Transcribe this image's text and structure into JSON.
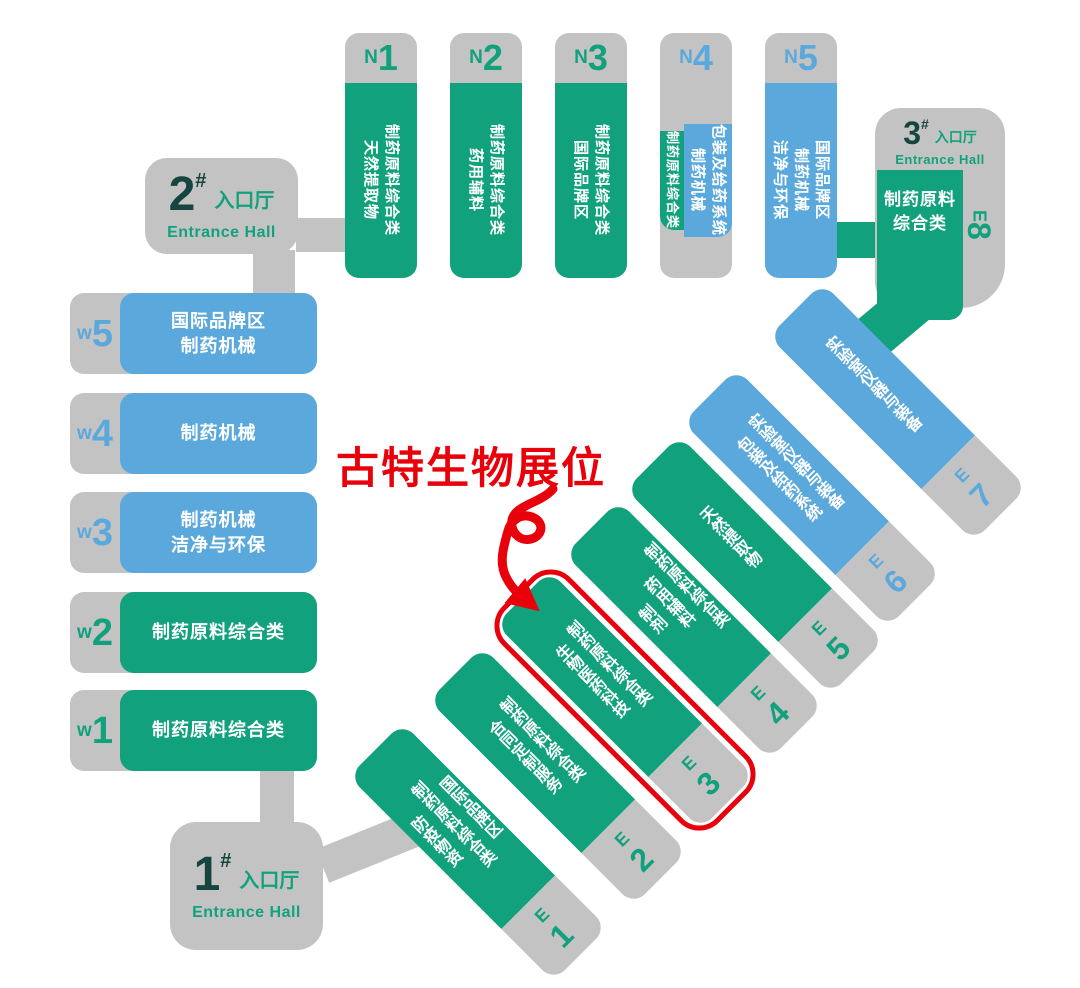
{
  "annotation": {
    "booth_label": "古特生物展位"
  },
  "entrances": {
    "e1": {
      "num": "1",
      "hash": "#",
      "cn": "入口厅",
      "en": "Entrance Hall"
    },
    "e2": {
      "num": "2",
      "hash": "#",
      "cn": "入口厅",
      "en": "Entrance Hall"
    },
    "e3": {
      "num": "3",
      "hash": "#",
      "cn": "入口厅",
      "en": "Entrance Hall"
    }
  },
  "n_halls": [
    {
      "prefix": "N",
      "num": "1",
      "color": "green",
      "lines": [
        "制药原料综合类",
        "天然提取物"
      ]
    },
    {
      "prefix": "N",
      "num": "2",
      "color": "green",
      "lines": [
        "制药原料综合类",
        "药用辅料"
      ]
    },
    {
      "prefix": "N",
      "num": "3",
      "color": "green",
      "lines": [
        "制药原料综合类",
        "国际品牌区"
      ]
    },
    {
      "prefix": "N",
      "num": "4",
      "color": "split",
      "strip_line": "制药原料综合类",
      "lines": [
        "包装及给药系统",
        "制药机械"
      ]
    },
    {
      "prefix": "N",
      "num": "5",
      "color": "blue",
      "lines": [
        "国际品牌区",
        "制药机械",
        "洁净与环保"
      ]
    }
  ],
  "w_halls": [
    {
      "prefix": "w",
      "num": "5",
      "color": "blue",
      "lines": [
        "国际品牌区",
        "制药机械"
      ]
    },
    {
      "prefix": "w",
      "num": "4",
      "color": "blue",
      "lines": [
        "制药机械"
      ]
    },
    {
      "prefix": "w",
      "num": "3",
      "color": "blue",
      "lines": [
        "制药机械",
        "洁净与环保"
      ]
    },
    {
      "prefix": "w",
      "num": "2",
      "color": "green",
      "lines": [
        "制药原料综合类"
      ]
    },
    {
      "prefix": "w",
      "num": "1",
      "color": "green",
      "lines": [
        "制药原料综合类"
      ]
    }
  ],
  "e_halls": [
    {
      "prefix": "E",
      "num": "1",
      "color": "green",
      "highlighted": false,
      "lines": [
        "国际品牌区",
        "制药原料综合类",
        "防疫物资"
      ]
    },
    {
      "prefix": "E",
      "num": "2",
      "color": "green",
      "highlighted": false,
      "lines": [
        "制药原料综合类",
        "合同定制服务"
      ]
    },
    {
      "prefix": "E",
      "num": "3",
      "color": "green",
      "highlighted": true,
      "lines": [
        "制药原料综合类",
        "生物医药科技"
      ]
    },
    {
      "prefix": "E",
      "num": "4",
      "color": "green",
      "highlighted": false,
      "lines": [
        "制药原料综合类",
        "药用辅料",
        "制剂"
      ]
    },
    {
      "prefix": "E",
      "num": "5",
      "color": "green",
      "highlighted": false,
      "lines": [
        "天然提取物"
      ]
    },
    {
      "prefix": "E",
      "num": "6",
      "color": "blue",
      "highlighted": false,
      "lines": [
        "实验室仪器与装备",
        "包装及给药系统"
      ]
    },
    {
      "prefix": "E",
      "num": "7",
      "color": "blue",
      "highlighted": false,
      "lines": [
        "实验室仪器与装备"
      ]
    }
  ],
  "e8": {
    "prefix": "E",
    "num": "8",
    "color": "green",
    "lines": [
      "制药原料",
      "综合类"
    ]
  },
  "colors": {
    "green": "#12A17D",
    "blue": "#5BA9DC",
    "gray": "#C3C3C3",
    "red": "#E8000B",
    "dark_numeral": "#16443F",
    "text_on_fill": "#FFFFFF"
  }
}
